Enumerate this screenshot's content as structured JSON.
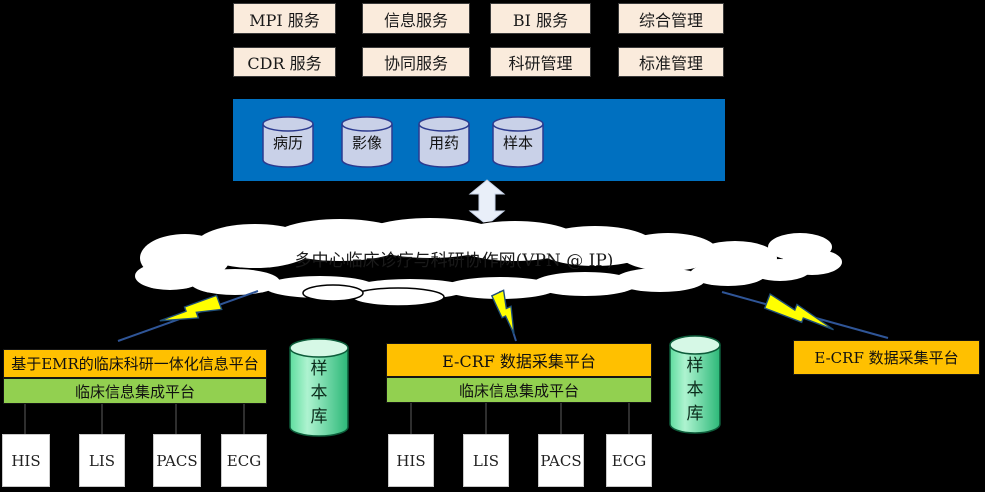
{
  "services": {
    "row1": [
      "MPI 服务",
      "信息服务",
      "BI 服务",
      "综合管理"
    ],
    "row2": [
      "CDR 服务",
      "协同服务",
      "科研管理",
      "标准管理"
    ]
  },
  "data_bar": {
    "databases": [
      "病历",
      "影像",
      "用药",
      "样本"
    ]
  },
  "cloud": {
    "label": "多中心临床诊疗与科研协作网(VPN @ IP)"
  },
  "sites": [
    {
      "platform_top": "基于EMR的临床科研一体化信息平台",
      "platform_bottom": "临床信息集成平台",
      "sample_store": "样本库",
      "systems": [
        "HIS",
        "LIS",
        "PACS",
        "ECG"
      ]
    },
    {
      "platform_top": "E-CRF 数据采集平台",
      "platform_bottom": "临床信息集成平台",
      "sample_store": "样本库",
      "systems": [
        "HIS",
        "LIS",
        "PACS",
        "ECG"
      ]
    },
    {
      "platform_top": "E-CRF 数据采集平台"
    }
  ],
  "colors": {
    "service_box": "#FAEBDC",
    "data_bar": "#0070C0",
    "db_cylinder": "#C9D1E8",
    "platform_primary": "#FFC000",
    "platform_integration": "#92D050",
    "sample_cylinder": "#3FCD8B",
    "bolt_fill": "#FFFF00",
    "bolt_outline": "#1F4E79",
    "cloud_fill": "#FFFFFF",
    "background": "#000000"
  }
}
